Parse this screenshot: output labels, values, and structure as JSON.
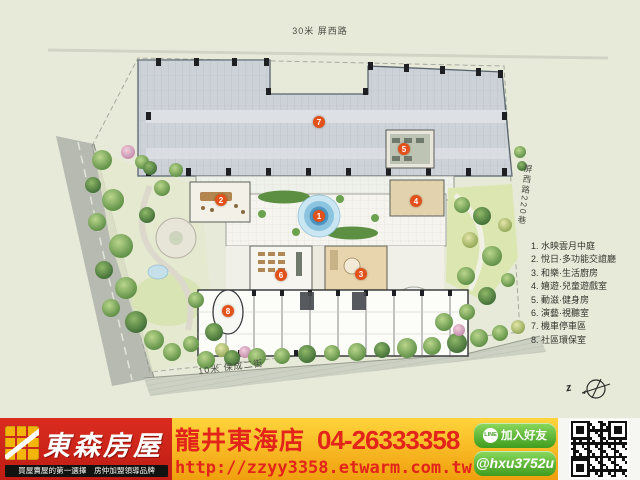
{
  "plan": {
    "road_top_label": "30米 屏西路",
    "road_right_label": "屏西路220巷",
    "road_bottom_label": "10米 保成二街",
    "compass_label": "z",
    "legend_items": [
      "1. 水映雲月中庭",
      "2. 悅日·多功能交誼廳",
      "3. 和樂·生活廚房",
      "4. 嬉遊·兒童遊戲室",
      "5. 動滋·健身房",
      "6. 演藝·視聽室",
      "7. 機車停車區",
      "8. 社區環保室"
    ],
    "markers": [
      {
        "n": "1",
        "x": 319,
        "y": 216
      },
      {
        "n": "2",
        "x": 221,
        "y": 200
      },
      {
        "n": "3",
        "x": 361,
        "y": 274
      },
      {
        "n": "4",
        "x": 416,
        "y": 201
      },
      {
        "n": "5",
        "x": 404,
        "y": 149
      },
      {
        "n": "6",
        "x": 281,
        "y": 275
      },
      {
        "n": "7",
        "x": 319,
        "y": 122
      },
      {
        "n": "8",
        "x": 228,
        "y": 311
      }
    ]
  },
  "banner": {
    "brand_name": "東森房屋",
    "tagline": "買屋賣屋的第一選擇　房仲加盟領導品牌",
    "store_name": "龍井東海店",
    "phone": "04-26333358",
    "url": "http://zzyy3358.etwarm.com.tw",
    "line_icon_label": "LINE",
    "line_button_label": "加入好友",
    "line_id": "@hxu3752u",
    "colors": {
      "brand_red": "#d0241b",
      "logo_yellow": "#f3b50a",
      "banner_yellow": "#f6ab14",
      "text_red": "#e2241a",
      "line_green": "#4aa823",
      "marker_orange": "#e2511a"
    }
  }
}
